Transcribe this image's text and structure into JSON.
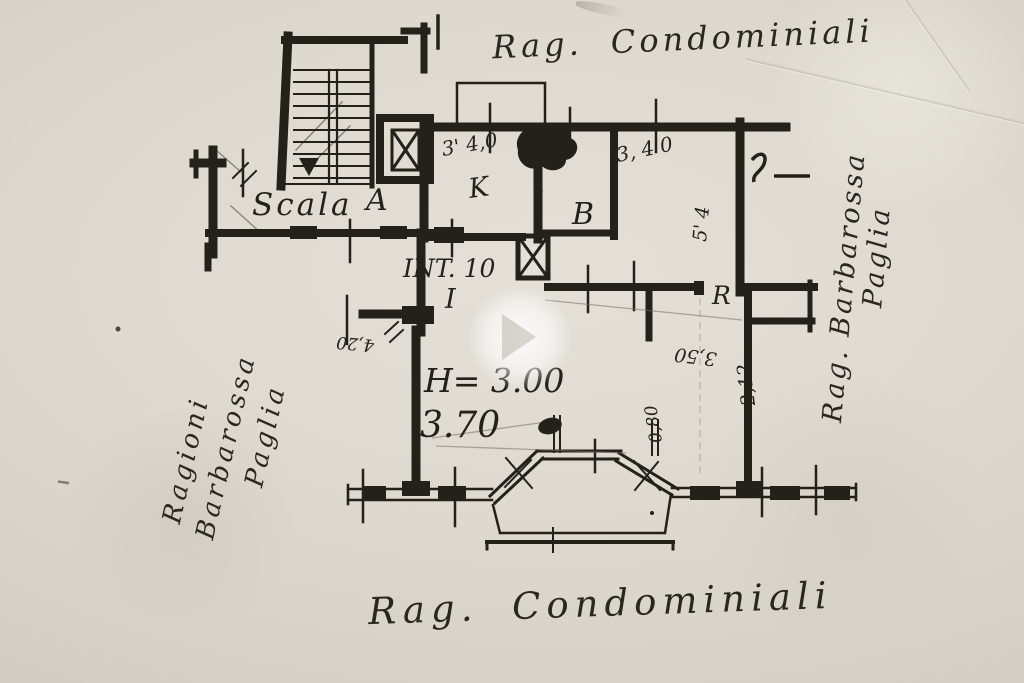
{
  "annotations": {
    "top_note": "Rag. Condominiali",
    "bottom_note": "Rag. Condominiali",
    "right_note_line1": "Rag. Barbarossa",
    "right_note_line2": "Paglia",
    "left_note_line1": "Ragioni",
    "left_note_line2": "Barbarossa",
    "left_note_line3": "Paglia"
  },
  "plan": {
    "unit_label": "INT. 10",
    "stair_label": "Scala",
    "stair_letter": "A",
    "room_k": "K",
    "room_b": "B",
    "room_i": "I",
    "room_r": "R"
  },
  "measurements": {
    "k_top": "3' 4,0",
    "right_top": "3, 4 0",
    "right_vert": "5' 4",
    "height_note": "H= 3.00",
    "width_note": "3.70",
    "left_rot": "4,20",
    "r_rot": "3,50",
    "r_vert": "2,12",
    "r_vert2": "0,80"
  },
  "ink_color": "#24211b"
}
